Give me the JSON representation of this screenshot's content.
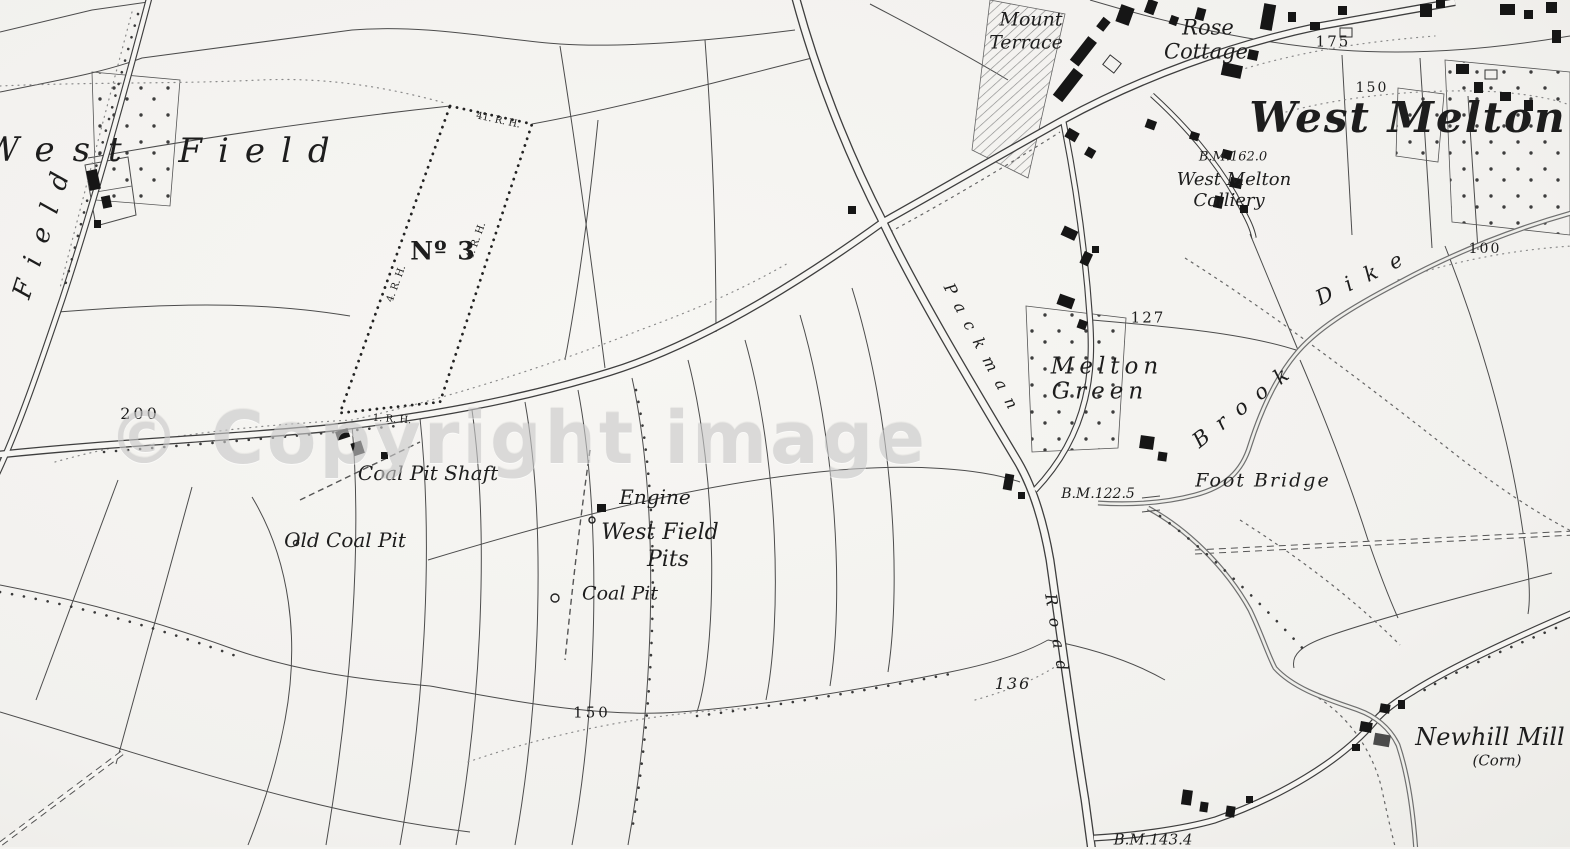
{
  "map": {
    "watermark": "© Copyright image",
    "accent_colors": {
      "ink": "#1d1d1d",
      "paper": "#f4f3f0",
      "watermark_gray": "#c9c9c9"
    },
    "labels": [
      {
        "name": "label-mount",
        "text": "Mount",
        "x": 1031,
        "y": 20,
        "size": 19
      },
      {
        "name": "label-terrace",
        "text": "Terrace",
        "x": 1026,
        "y": 43,
        "size": 19
      },
      {
        "name": "label-rose",
        "text": "Rose",
        "x": 1208,
        "y": 28,
        "size": 21
      },
      {
        "name": "label-cottage",
        "text": "Cottage",
        "x": 1206,
        "y": 52,
        "size": 21
      },
      {
        "name": "label-spot-175",
        "text": "175",
        "x": 1333,
        "y": 42,
        "size": 15,
        "italic": false,
        "spacing": 2
      },
      {
        "name": "label-contour-150-ne",
        "text": "150",
        "x": 1372,
        "y": 88,
        "size": 14,
        "italic": false,
        "spacing": 2
      },
      {
        "name": "label-west-melton",
        "text": "West Melton",
        "x": 1408,
        "y": 118,
        "size": 42,
        "weight": "700",
        "spacing": 2
      },
      {
        "name": "label-bm-162",
        "text": "B.M.162.0",
        "x": 1233,
        "y": 157,
        "size": 13
      },
      {
        "name": "label-colliery-1",
        "text": "West Melton",
        "x": 1234,
        "y": 180,
        "size": 18
      },
      {
        "name": "label-colliery-2",
        "text": "Colliery",
        "x": 1229,
        "y": 201,
        "size": 18
      },
      {
        "name": "label-west-big",
        "text": "West",
        "x": 62,
        "y": 150,
        "size": 34,
        "spacing": 18
      },
      {
        "name": "label-field-big",
        "text": "Field",
        "x": 262,
        "y": 151,
        "size": 34,
        "spacing": 16
      },
      {
        "name": "label-field-vertical",
        "text": "Field",
        "x": 44,
        "y": 228,
        "size": 26,
        "spacing": 16,
        "rot": -72
      },
      {
        "name": "label-no3",
        "text": "Nº 3",
        "x": 443,
        "y": 251,
        "size": 25,
        "italic": false,
        "weight": "700",
        "spacing": 1
      },
      {
        "name": "label-mereing-top",
        "text": "41. R. H.",
        "x": 498,
        "y": 121,
        "size": 10,
        "rot": 12,
        "italic": false
      },
      {
        "name": "label-mereing-left",
        "text": "4. R. H.",
        "x": 397,
        "y": 284,
        "size": 10,
        "rot": -70,
        "italic": false
      },
      {
        "name": "label-mereing-right",
        "text": "4. R. H.",
        "x": 477,
        "y": 241,
        "size": 10,
        "rot": -70,
        "italic": false
      },
      {
        "name": "label-mereing-bottom",
        "text": "1. R. H.",
        "x": 392,
        "y": 420,
        "size": 10,
        "rot": 4,
        "italic": false
      },
      {
        "name": "label-contour-200",
        "text": "200",
        "x": 140,
        "y": 414,
        "size": 16,
        "italic": false,
        "spacing": 3
      },
      {
        "name": "label-coal-pit-shaft",
        "text": "Coal Pit Shaft",
        "x": 428,
        "y": 473,
        "size": 20
      },
      {
        "name": "label-old-coal-pit",
        "text": "Old Coal Pit",
        "x": 345,
        "y": 540,
        "size": 20
      },
      {
        "name": "label-engine",
        "text": "Engine",
        "x": 655,
        "y": 497,
        "size": 20
      },
      {
        "name": "label-west-field-pits1",
        "text": "West Field",
        "x": 660,
        "y": 533,
        "size": 22
      },
      {
        "name": "label-west-field-pits2",
        "text": "Pits",
        "x": 668,
        "y": 560,
        "size": 22
      },
      {
        "name": "label-coal-pit",
        "text": "Coal Pit",
        "x": 620,
        "y": 594,
        "size": 19
      },
      {
        "name": "label-contour-150-s",
        "text": "150",
        "x": 592,
        "y": 713,
        "size": 15,
        "italic": false,
        "spacing": 3
      },
      {
        "name": "label-spot-136",
        "text": "136",
        "x": 1013,
        "y": 684,
        "size": 16,
        "spacing": 2
      },
      {
        "name": "label-melton-green-1",
        "text": "Melton",
        "x": 1107,
        "y": 367,
        "size": 23,
        "spacing": 5
      },
      {
        "name": "label-melton-green-2",
        "text": "Green",
        "x": 1100,
        "y": 392,
        "size": 23,
        "spacing": 5
      },
      {
        "name": "label-spot-127",
        "text": "127",
        "x": 1148,
        "y": 318,
        "size": 15,
        "italic": false,
        "spacing": 2
      },
      {
        "name": "label-bm-122",
        "text": "B.M.122.5",
        "x": 1098,
        "y": 494,
        "size": 14
      },
      {
        "name": "label-foot-bridge",
        "text": "Foot Bridge",
        "x": 1263,
        "y": 481,
        "size": 19,
        "spacing": 2
      },
      {
        "name": "label-brook",
        "text": "Brook",
        "x": 1246,
        "y": 404,
        "size": 21,
        "spacing": 13,
        "rot": -38
      },
      {
        "name": "label-dike",
        "text": "Dike",
        "x": 1366,
        "y": 276,
        "size": 21,
        "spacing": 15,
        "rot": -26
      },
      {
        "name": "label-contour-100",
        "text": "100",
        "x": 1485,
        "y": 249,
        "size": 14,
        "italic": false,
        "spacing": 2
      },
      {
        "name": "label-newhill-mill",
        "text": "Newhill Mill",
        "x": 1490,
        "y": 737,
        "size": 24
      },
      {
        "name": "label-newhill-corn",
        "text": "(Corn)",
        "x": 1497,
        "y": 761,
        "size": 15
      },
      {
        "name": "label-bm-143",
        "text": "B.M.143.4",
        "x": 1153,
        "y": 840,
        "size": 15
      },
      {
        "name": "label-packman",
        "text": "Packman",
        "x": 983,
        "y": 351,
        "size": 16,
        "spacing": 11,
        "rot": 62
      },
      {
        "name": "label-road",
        "text": "Road",
        "x": 1057,
        "y": 638,
        "size": 16,
        "spacing": 12,
        "rot": 81
      }
    ]
  }
}
